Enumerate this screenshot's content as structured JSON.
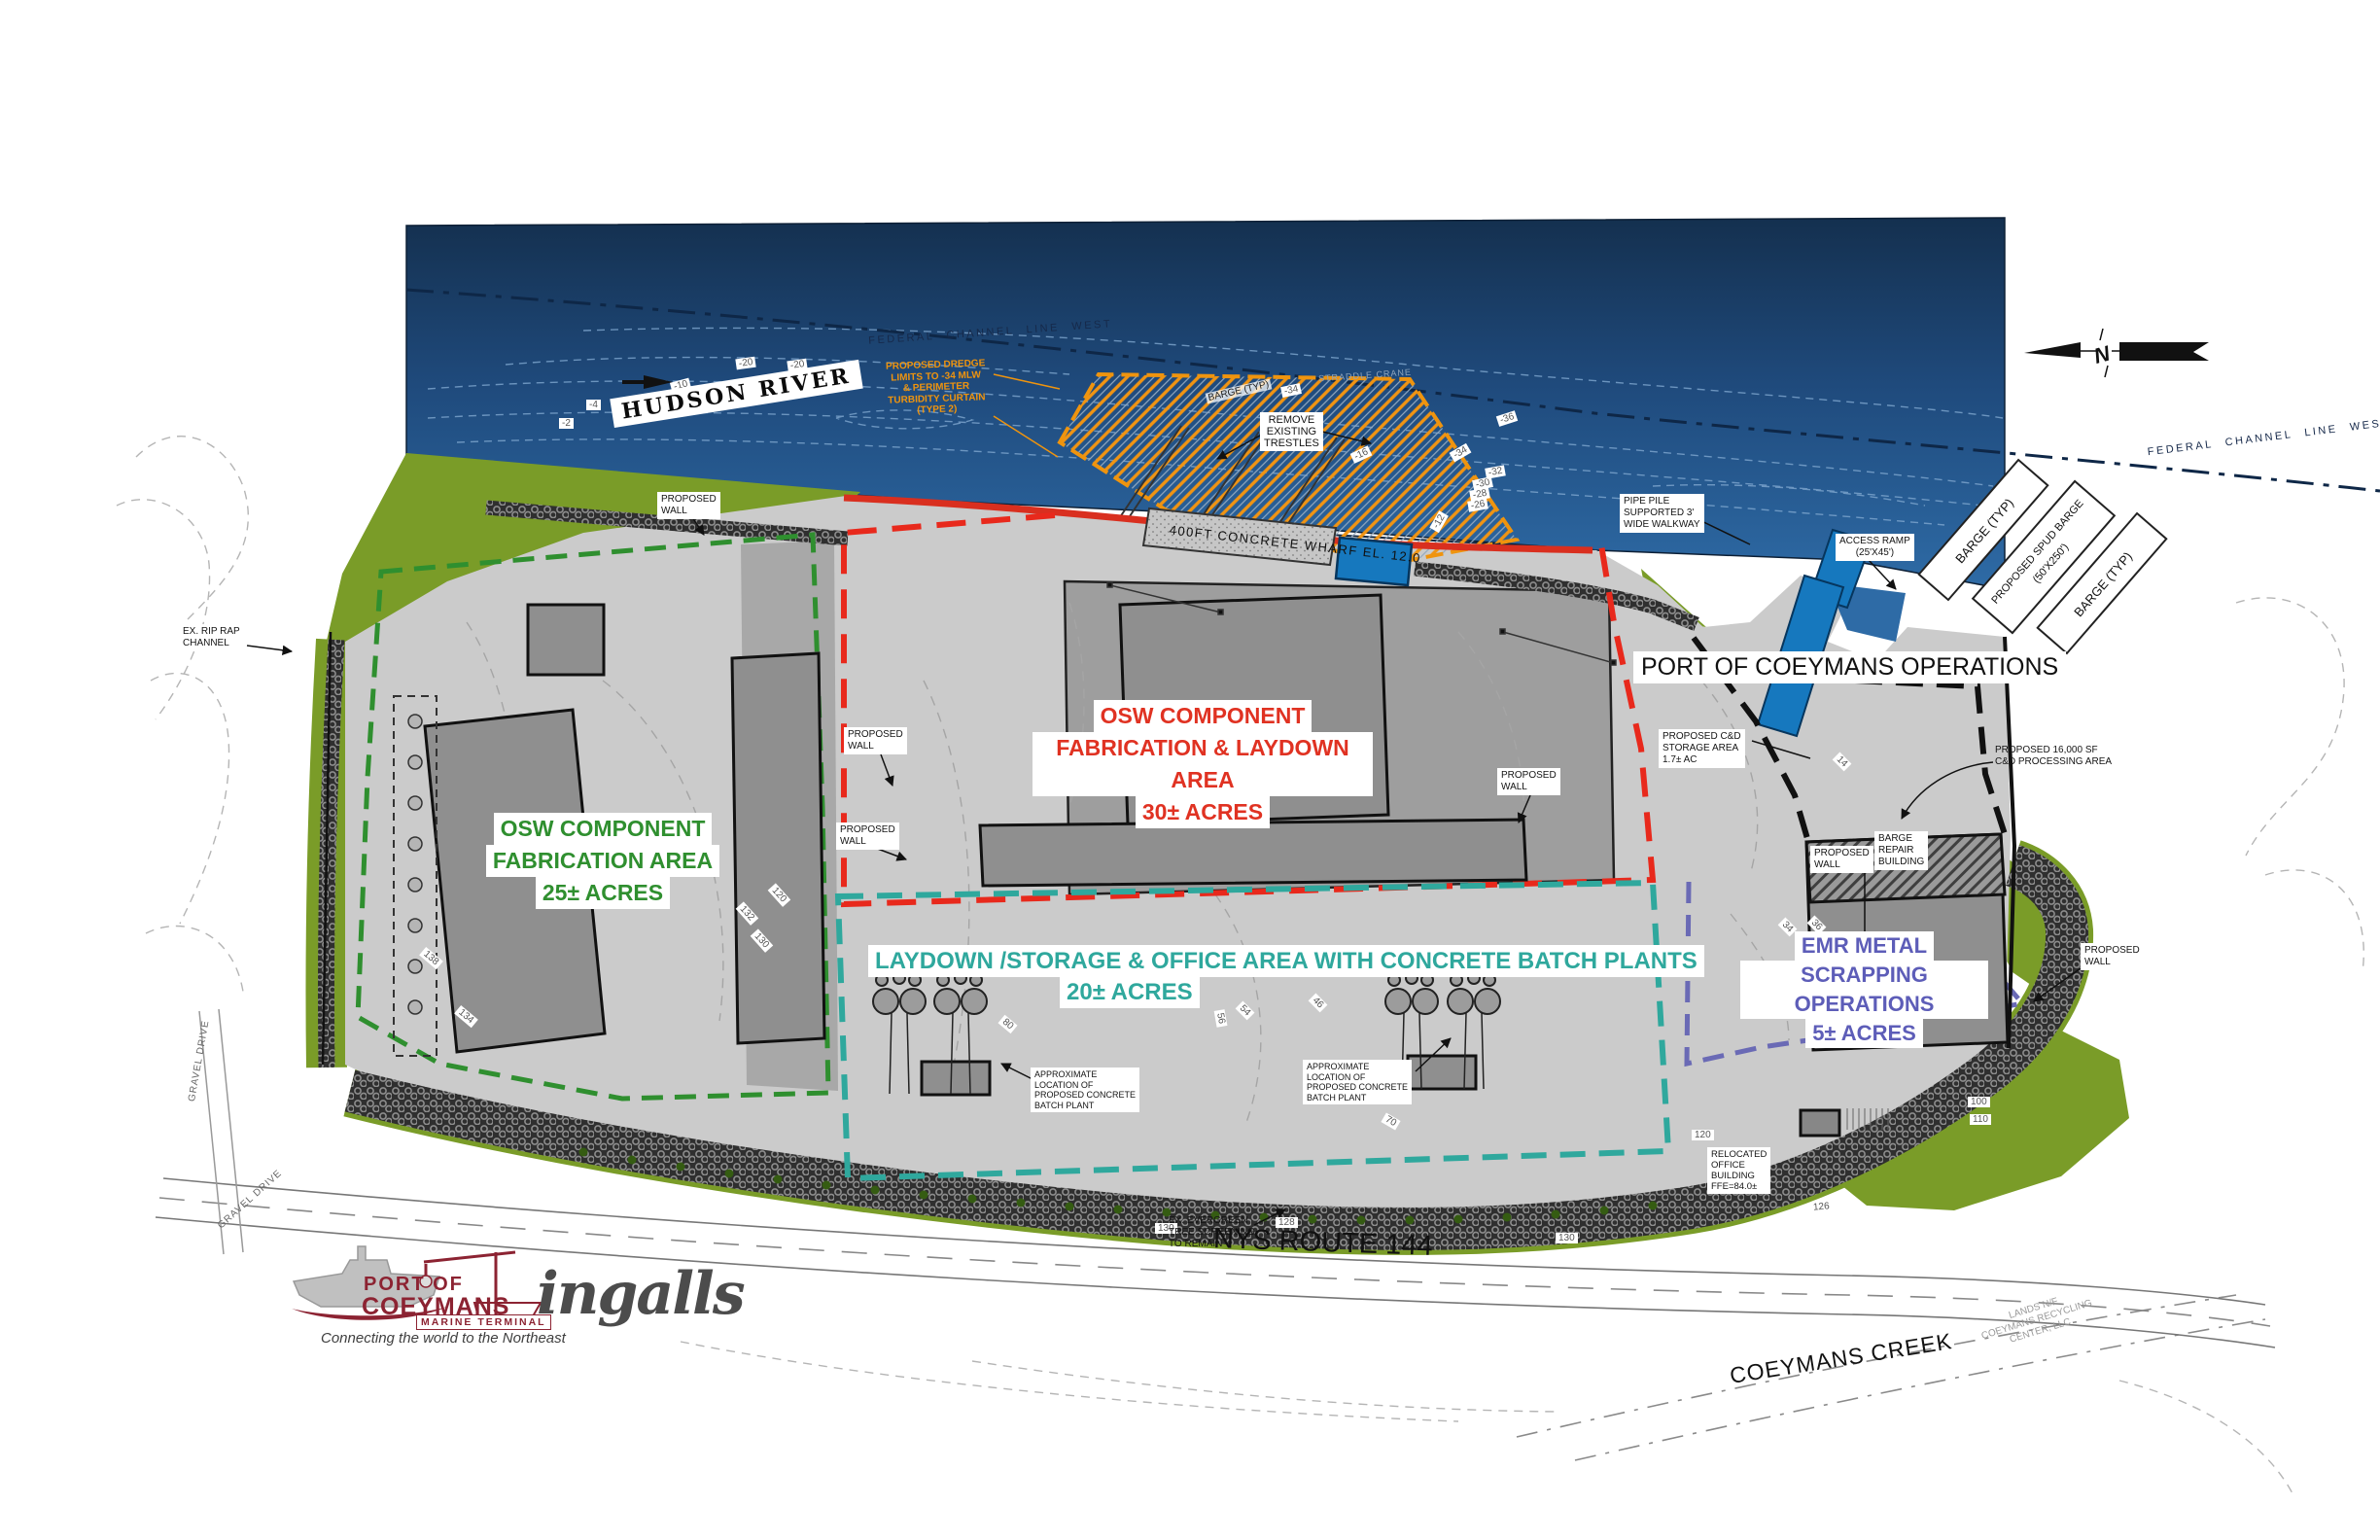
{
  "colors": {
    "water_deep": "#16355e",
    "water": "#2e6ba6",
    "site_gray": "#cbcbcb",
    "pad_gray": "#9e9e9e",
    "building": "#8f8f8f",
    "green": "#7a9c28",
    "area_green": "#2f8f2f",
    "area_red": "#e03222",
    "area_teal": "#2fa89d",
    "area_purple": "#5d5db8",
    "orange": "#ef940e",
    "maroon": "#8c2332"
  },
  "river": {
    "name": "HUDSON RIVER",
    "channel_line": "FEDERAL CHANNEL LINE WEST",
    "dredge_note": {
      "l1": "PROPOSED DREDGE",
      "l2": "LIMITS TO -34 MLW",
      "l3": "& PERIMETER",
      "l4": "TURBIDITY CURTAIN",
      "l5": "(TYPE 2)"
    },
    "remove_trestles": {
      "l1": "REMOVE",
      "l2": "EXISTING",
      "l3": "TRESTLES"
    },
    "straddle_crane": "STRADDLE CRANE",
    "barge_typ": "BARGE (TYP)",
    "spud_barge": {
      "l1": "PROPOSED SPUD BARGE",
      "l2": "(50'X250')"
    },
    "access_ramp": {
      "l1": "ACCESS RAMP",
      "l2": "(25'X45')"
    },
    "pipe_pile": {
      "l1": "PIPE PILE",
      "l2": "SUPPORTED 3'",
      "l3": "WIDE WALKWAY"
    },
    "wharf": "400FT CONCRETE WHARF EL. 12.0",
    "depths": [
      "-2",
      "-4",
      "-8",
      "-10",
      "-20",
      "-20",
      "-16",
      "-12",
      "-26",
      "-28",
      "-30",
      "-32",
      "-34",
      "-36",
      "-34"
    ]
  },
  "areas": {
    "fab": {
      "l1": "OSW COMPONENT",
      "l2": "FABRICATION AREA",
      "l3": "25± ACRES"
    },
    "laydown": {
      "l1": "OSW COMPONENT",
      "l2": "FABRICATION & LAYDOWN AREA",
      "l3": "30± ACRES"
    },
    "storage": {
      "l1": "LAYDOWN /STORAGE  & OFFICE AREA WITH CONCRETE BATCH PLANTS",
      "l2": "20± ACRES"
    },
    "emr": {
      "l1": "EMR METAL",
      "l2": "SCRAPPING OPERATIONS",
      "l3": "5± ACRES"
    },
    "operations": "PORT OF COEYMANS OPERATIONS"
  },
  "notes": {
    "proposed_wall": {
      "l1": "PROPOSED",
      "l2": "WALL"
    },
    "cd_storage": {
      "l1": "PROPOSED C&D",
      "l2": "STORAGE AREA",
      "l3": "1.7± AC"
    },
    "cd_processing": {
      "l1": "PROPOSED 16,000 SF",
      "l2": "C&D PROCESSING AREA"
    },
    "barge_repair": {
      "l1": "BARGE",
      "l2": "REPAIR",
      "l3": "BUILDING"
    },
    "batch_plant": {
      "l1": "APPROXIMATE",
      "l2": "LOCATION OF",
      "l3": "PROPOSED CONCRETE",
      "l4": "BATCH PLANT"
    },
    "relocated_office": {
      "l1": "RELOCATED",
      "l2": "OFFICE",
      "l3": "BUILDING",
      "l4": "FFE=84.0±"
    },
    "evergreen": {
      "l1": "EX. EVERGREEN",
      "l2": "TREE SCREENING",
      "l3": "TO REMAIN"
    },
    "rip_rap": {
      "l1": "EX. RIP RAP",
      "l2": "CHANNEL"
    },
    "gravel_drive": "GRAVEL DRIVE",
    "lands": {
      "l1": "LANDS N/F",
      "l2": "COEYMANS RECYCLING",
      "l3": "CENTER, LLC"
    },
    "route": "NYS ROUTE 144",
    "creek": "COEYMANS CREEK",
    "north": "N"
  },
  "contours": [
    "120",
    "132",
    "130",
    "134",
    "138",
    "14",
    "80",
    "70",
    "56",
    "54",
    "46",
    "44",
    "34",
    "36",
    "100",
    "110",
    "120",
    "126",
    "128",
    "130",
    "130"
  ],
  "logos": {
    "poc": {
      "line1": "PORT OF",
      "line2": "COEYMANS",
      "sub": "MARINE TERMINAL",
      "tagline": "Connecting the world to the Northeast"
    },
    "ingalls": "ingalls"
  }
}
